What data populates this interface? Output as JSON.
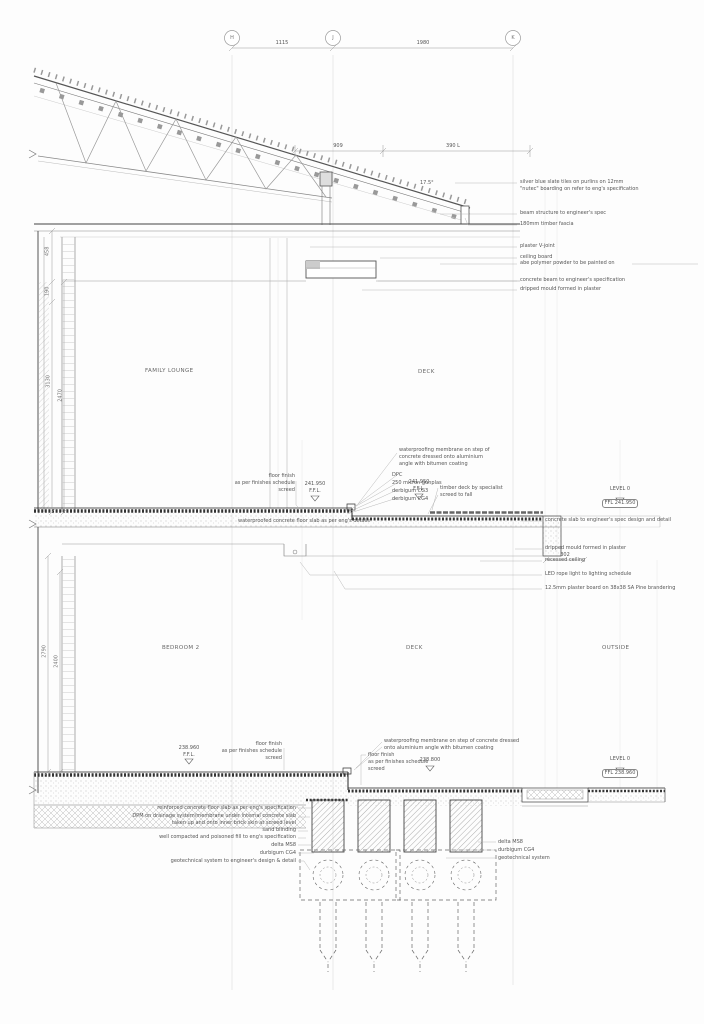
{
  "grid": {
    "b1": "H",
    "b2": "J",
    "b3": "K"
  },
  "dims": {
    "top1": "1115",
    "top2": "1980",
    "roof1": "909",
    "roof2": "390 L",
    "angle": "17.5°",
    "left_upper1": "458",
    "left_upper2": "190",
    "left_mid1": "3130",
    "left_mid2": "2470",
    "left_low1": "2790",
    "left_low2": "2400",
    "ceiling_step": "302"
  },
  "rooms": {
    "family_lounge": "FAMILY LOUNGE",
    "deck_upper": "DECK",
    "bedroom2": "BEDROOM 2",
    "deck_lower": "DECK",
    "outside": "OUTSIDE"
  },
  "levels": {
    "level0_label": "LEVEL 0",
    "upper_left": "241.950\nF.F.L.",
    "upper_mid": "241.950\nF.F.L.",
    "upper_box": "FFL 241.950",
    "lower_left": "238.960\nF.F.L.",
    "lower_deck": "238.800",
    "lower_box": "FFL 238.960"
  },
  "notes_roof": {
    "tiles": "silver blue slate tiles on purlins on 12mm\n\"nutec\" boarding on refer to eng's specification",
    "beam": "beam structure to engineer's spec",
    "fascia": "180mm timber fascia",
    "vjoint": "plaster V-joint",
    "ceiling_board": "ceiling board",
    "polymer": "abe polymer powder to be painted on",
    "concrete_beam": "concrete beam to engineer's specification",
    "drip": "dripped mould formed in plaster"
  },
  "notes_mid": {
    "membrane": "waterproofing membrane on step of\nconcrete dressed onto aluminium\nangle with bitumen coating",
    "dpc": "DPC",
    "gunplas": "250 micron gunplas",
    "cg3": "derbigum CG3",
    "cg4": "derbigum CG4",
    "timber_deck": "timber deck by specialist",
    "screed": "screed to fall",
    "floor_finish": "floor finish\nas per finishes schedule\nscreed",
    "slab_note": "waterproofed concrete floor slab as per eng's details"
  },
  "notes_ceiling": {
    "slab_spec": "concrete slab to engineer's spec design and detail",
    "drip": "dripped mould formed in plaster",
    "recessed": "recessed ceiling",
    "led": "LED rope light to lighting schedule",
    "plasterboard": "12.5mm plaster board on 38x38 SA Pine brandering"
  },
  "notes_lower": {
    "membrane": "waterproofing membrane on step of concrete dressed\nonto aluminium angle with bitumen coating",
    "floor_finish_right": "floor finish\nas per finishes schedule\nscreed",
    "floor_finish_left": "floor finish\nas per finishes schedule\nscreed"
  },
  "notes_fnd_left": {
    "rc_slab": "reinforced concrete floor slab as per eng's specification",
    "dpm": "DPM on drainage system/membrane under internal concrete slab\ntaken up and onto inner brick skin at screed level",
    "sand": "sand blinding",
    "fill": "well compacted and poisoned fill to eng's specification",
    "delta": "delta MS8",
    "durbigum": "durbigum CG4",
    "geotech": "geotechnical system to engineer's design & detail"
  },
  "notes_fnd_right": {
    "delta": "delta MS8",
    "durbigum": "durbigum CG4",
    "geotech": "geotechnical system"
  }
}
